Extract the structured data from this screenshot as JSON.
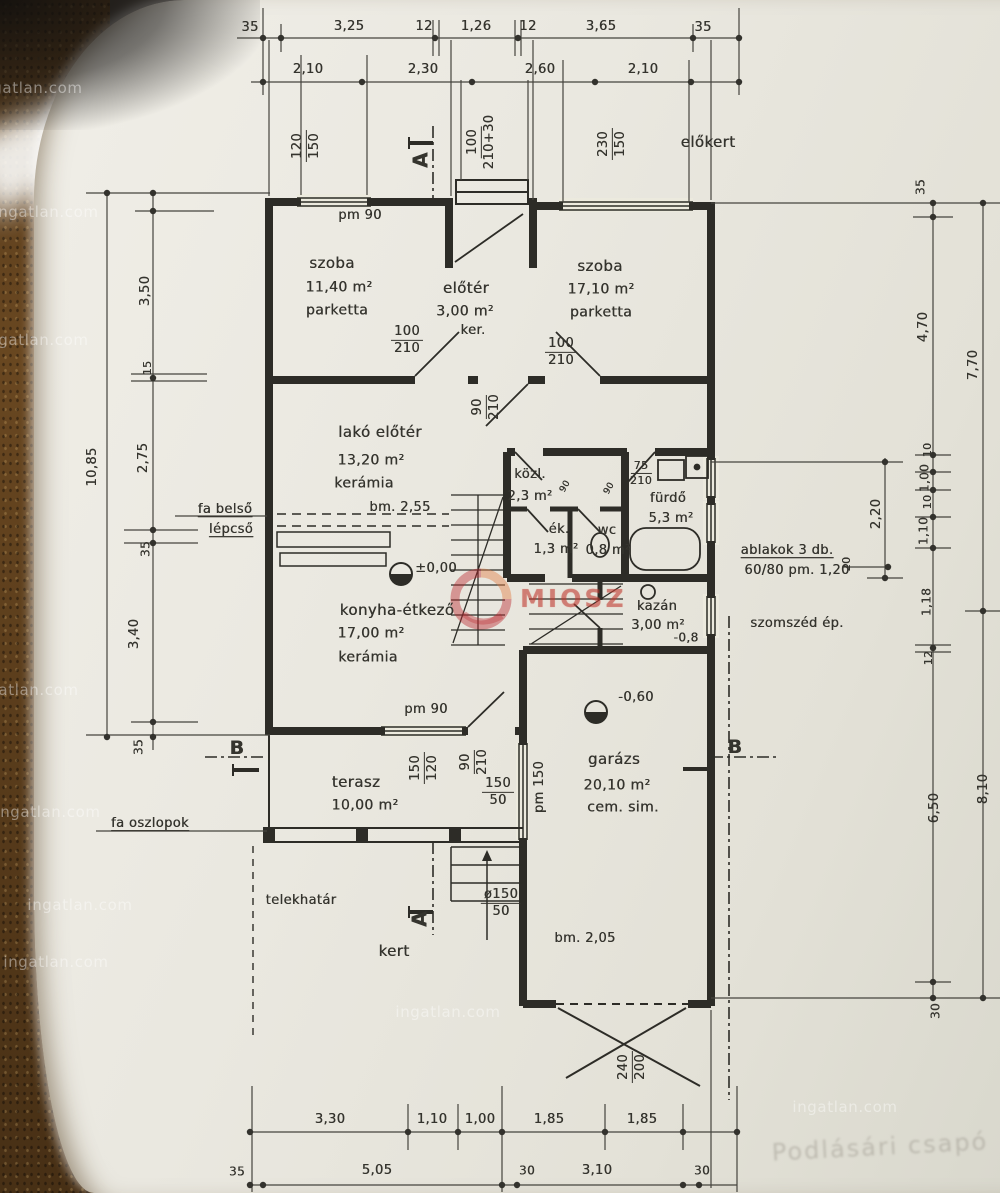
{
  "watermarks": {
    "text": "ingatlan.com",
    "positions": [
      {
        "x": 30,
        "y": 88
      },
      {
        "x": 46,
        "y": 212
      },
      {
        "x": 36,
        "y": 340
      },
      {
        "x": 26,
        "y": 690
      },
      {
        "x": 48,
        "y": 812
      },
      {
        "x": 80,
        "y": 905
      },
      {
        "x": 56,
        "y": 962
      },
      {
        "x": 448,
        "y": 1012
      },
      {
        "x": 845,
        "y": 1107
      }
    ]
  },
  "logo": {
    "text": "MIOSZ"
  },
  "faint_note": "Podlásári csapó",
  "plan": {
    "labels": [
      {
        "n": "dim-top-35-left",
        "t": "35",
        "x": 250,
        "y": 28
      },
      {
        "n": "dim-top-3-25",
        "t": "3,25",
        "x": 349,
        "y": 27
      },
      {
        "n": "dim-top-12-a",
        "t": "12",
        "x": 424,
        "y": 27
      },
      {
        "n": "dim-top-1-26",
        "t": "1,26",
        "x": 476,
        "y": 27
      },
      {
        "n": "dim-top-12-b",
        "t": "12",
        "x": 528,
        "y": 27
      },
      {
        "n": "dim-top-3-65",
        "t": "3,65",
        "x": 601,
        "y": 27
      },
      {
        "n": "dim-top-35-right",
        "t": "35",
        "x": 703,
        "y": 28
      },
      {
        "n": "dim-top2-2-10-a",
        "t": "2,10",
        "x": 308,
        "y": 70
      },
      {
        "n": "dim-top2-2-30",
        "t": "2,30",
        "x": 423,
        "y": 70
      },
      {
        "n": "dim-top2-2-60",
        "t": "2,60",
        "x": 540,
        "y": 70
      },
      {
        "n": "dim-top2-2-10-b",
        "t": "2,10",
        "x": 643,
        "y": 70
      },
      {
        "n": "window-dim-120-150",
        "t": "120|150",
        "x": 306,
        "y": 146,
        "r": -90
      },
      {
        "n": "section-letter-a-top",
        "t": "A",
        "x": 421,
        "y": 160,
        "r": -90,
        "b": 1,
        "s": 20
      },
      {
        "n": "door-dim-100-210-30",
        "t": "100|210+30",
        "x": 481,
        "y": 142,
        "r": -90
      },
      {
        "n": "window-dim-230-150",
        "t": "230|150",
        "x": 612,
        "y": 144,
        "r": -90
      },
      {
        "n": "label-elokert",
        "t": "előkert",
        "x": 708,
        "y": 143,
        "s": 15
      },
      {
        "n": "label-pm90-top",
        "t": "pm 90",
        "x": 360,
        "y": 216
      },
      {
        "n": "room-szoba1-name",
        "t": "szoba",
        "x": 332,
        "y": 264,
        "s": 15
      },
      {
        "n": "room-szoba1-area",
        "t": "11,40 m²",
        "x": 339,
        "y": 288,
        "s": 14
      },
      {
        "n": "room-szoba1-floor",
        "t": "parketta",
        "x": 337,
        "y": 311,
        "s": 14
      },
      {
        "n": "room-eloter-name",
        "t": "előtér",
        "x": 466,
        "y": 289,
        "s": 15
      },
      {
        "n": "room-eloter-area",
        "t": "3,00 m²",
        "x": 465,
        "y": 312,
        "s": 14
      },
      {
        "n": "room-eloter-floor",
        "t": "ker.",
        "x": 473,
        "y": 331
      },
      {
        "n": "room-szoba2-name",
        "t": "szoba",
        "x": 600,
        "y": 267,
        "s": 15
      },
      {
        "n": "room-szoba2-area",
        "t": "17,10 m²",
        "x": 601,
        "y": 290,
        "s": 14
      },
      {
        "n": "room-szoba2-floor",
        "t": "parketta",
        "x": 601,
        "y": 313,
        "s": 14
      },
      {
        "n": "door-dim-100-210-a",
        "t": "100|210",
        "x": 407,
        "y": 340
      },
      {
        "n": "door-dim-100-210-b",
        "t": "100|210",
        "x": 561,
        "y": 352
      },
      {
        "n": "room-lako-name",
        "t": "lakó előtér",
        "x": 380,
        "y": 433,
        "s": 15
      },
      {
        "n": "room-lako-area",
        "t": "13,20 m²",
        "x": 371,
        "y": 461,
        "s": 14
      },
      {
        "n": "room-lako-floor",
        "t": "kerámia",
        "x": 364,
        "y": 484,
        "s": 14
      },
      {
        "n": "door-dim-90-210-a",
        "t": "90|210",
        "x": 486,
        "y": 407,
        "r": -90
      },
      {
        "n": "room-kozl-name",
        "t": "közl.",
        "x": 530,
        "y": 475
      },
      {
        "n": "room-kozl-area",
        "t": "2,3 m²",
        "x": 530,
        "y": 497
      },
      {
        "n": "door-leaf-90-a",
        "t": "90",
        "x": 566,
        "y": 487,
        "r": -60,
        "s": 9
      },
      {
        "n": "door-leaf-90-b",
        "t": "90",
        "x": 610,
        "y": 489,
        "r": -60,
        "s": 9
      },
      {
        "n": "door-dim-75-210",
        "t": "75|210",
        "x": 641,
        "y": 473,
        "s": 11
      },
      {
        "n": "room-furdo-name",
        "t": "fürdő",
        "x": 668,
        "y": 499
      },
      {
        "n": "room-furdo-area",
        "t": "5,3 m²",
        "x": 671,
        "y": 519
      },
      {
        "n": "room-ek-name",
        "t": "ék.",
        "x": 559,
        "y": 530
      },
      {
        "n": "room-ek-area",
        "t": "1,3 m²",
        "x": 556,
        "y": 550
      },
      {
        "n": "room-wc-name",
        "t": "wc",
        "x": 607,
        "y": 531
      },
      {
        "n": "room-wc-area",
        "t": "0,8 m²",
        "x": 608,
        "y": 551
      },
      {
        "n": "label-bm-255",
        "t": "bm. 2,55",
        "x": 400,
        "y": 508
      },
      {
        "n": "label-fa-belso",
        "t": "fa belső",
        "x": 225,
        "y": 510,
        "u": 1
      },
      {
        "n": "label-lepcso",
        "t": "lépcső",
        "x": 231,
        "y": 530,
        "u": 1
      },
      {
        "n": "level-pm-000",
        "t": "±0,00",
        "x": 436,
        "y": 569
      },
      {
        "n": "room-konyha-name",
        "t": "konyha-étkező",
        "x": 397,
        "y": 611,
        "s": 15
      },
      {
        "n": "room-konyha-area",
        "t": "17,00 m²",
        "x": 371,
        "y": 634,
        "s": 14
      },
      {
        "n": "room-konyha-floor",
        "t": "kerámia",
        "x": 368,
        "y": 658,
        "s": 14
      },
      {
        "n": "room-kazan-name",
        "t": "kazán",
        "x": 657,
        "y": 607
      },
      {
        "n": "room-kazan-area",
        "t": "3,00 m²",
        "x": 658,
        "y": 626
      },
      {
        "n": "room-kazan-level",
        "t": "-0,8",
        "x": 686,
        "y": 638,
        "s": 12
      },
      {
        "n": "note-ablakok-1",
        "t": "ablakok 3 db.",
        "x": 787,
        "y": 551,
        "u": 1
      },
      {
        "n": "note-ablakok-2",
        "t": "60/80 pm. 1,20",
        "x": 797,
        "y": 571
      },
      {
        "n": "note-szomszed",
        "t": "szomszéd ép.",
        "x": 797,
        "y": 624
      },
      {
        "n": "level-m-060",
        "t": "-0,60",
        "x": 636,
        "y": 698
      },
      {
        "n": "label-pm90-bottom",
        "t": "pm 90",
        "x": 426,
        "y": 710
      },
      {
        "n": "section-letter-b-left",
        "t": "B",
        "x": 237,
        "y": 749,
        "b": 1,
        "s": 19
      },
      {
        "n": "room-terasz-name",
        "t": "terasz",
        "x": 356,
        "y": 783,
        "s": 15
      },
      {
        "n": "room-terasz-area",
        "t": "10,00 m²",
        "x": 365,
        "y": 806,
        "s": 14
      },
      {
        "n": "window-dim-150-120",
        "t": "150|120",
        "x": 424,
        "y": 768,
        "r": -90
      },
      {
        "n": "door-dim-90-210-b",
        "t": "90|210",
        "x": 474,
        "y": 762,
        "r": -90
      },
      {
        "n": "window-dim-150-50-a",
        "t": "150|50",
        "x": 498,
        "y": 792
      },
      {
        "n": "label-pm-150",
        "t": "pm 150",
        "x": 540,
        "y": 787,
        "r": -90
      },
      {
        "n": "room-garazs-name",
        "t": "garázs",
        "x": 614,
        "y": 760,
        "s": 15
      },
      {
        "n": "room-garazs-area",
        "t": "20,10 m²",
        "x": 617,
        "y": 786,
        "s": 14
      },
      {
        "n": "room-garazs-floor",
        "t": "cem. sim.",
        "x": 623,
        "y": 808,
        "s": 14
      },
      {
        "n": "section-letter-b-right",
        "t": "B",
        "x": 735,
        "y": 748,
        "b": 1,
        "s": 19
      },
      {
        "n": "label-fa-oszlopok",
        "t": "fa oszlopok",
        "x": 150,
        "y": 824,
        "u": 1
      },
      {
        "n": "label-telekhatar",
        "t": "telekhatár",
        "x": 301,
        "y": 901
      },
      {
        "n": "section-letter-a-bottom",
        "t": "A",
        "x": 420,
        "y": 919,
        "r": -90,
        "b": 1,
        "s": 20
      },
      {
        "n": "step-dim-150-50",
        "t": "ø150|50",
        "x": 501,
        "y": 903
      },
      {
        "n": "label-kert",
        "t": "kert",
        "x": 394,
        "y": 952,
        "s": 15
      },
      {
        "n": "label-bm-205",
        "t": "bm. 2,05",
        "x": 585,
        "y": 939
      },
      {
        "n": "garagedoor-dim-240-200",
        "t": "240|200",
        "x": 632,
        "y": 1067,
        "r": -90
      },
      {
        "n": "dim-left-10-85",
        "t": "10,85",
        "x": 93,
        "y": 467,
        "r": -90
      },
      {
        "n": "dim-left-3-50",
        "t": "3,50",
        "x": 146,
        "y": 291,
        "r": -90
      },
      {
        "n": "dim-left-15",
        "t": "15",
        "x": 148,
        "y": 368,
        "r": -90,
        "s": 11
      },
      {
        "n": "dim-left-2-75",
        "t": "2,75",
        "x": 144,
        "y": 458,
        "r": -90
      },
      {
        "n": "dim-left-35-a",
        "t": "35",
        "x": 146,
        "y": 549,
        "r": -90,
        "s": 12
      },
      {
        "n": "dim-left-3-40",
        "t": "3,40",
        "x": 135,
        "y": 634,
        "r": -90
      },
      {
        "n": "dim-left-35-b",
        "t": "35",
        "x": 139,
        "y": 747,
        "r": -90,
        "s": 12
      },
      {
        "n": "dim-right-35",
        "t": "35",
        "x": 921,
        "y": 187,
        "r": -90,
        "s": 12
      },
      {
        "n": "dim-right-4-70",
        "t": "4,70",
        "x": 924,
        "y": 327,
        "r": -90
      },
      {
        "n": "dim-right-7-70",
        "t": "7,70",
        "x": 974,
        "y": 365,
        "r": -90
      },
      {
        "n": "dim-right-10-a",
        "t": "10",
        "x": 928,
        "y": 450,
        "r": -90,
        "s": 11
      },
      {
        "n": "dim-right-1-00",
        "t": "1,00",
        "x": 925,
        "y": 478,
        "r": -90,
        "s": 12
      },
      {
        "n": "dim-right-10-b",
        "t": "10",
        "x": 928,
        "y": 502,
        "r": -90,
        "s": 11
      },
      {
        "n": "dim-right-1-10",
        "t": "1,10",
        "x": 924,
        "y": 531,
        "r": -90,
        "s": 12
      },
      {
        "n": "dim-right-2-20",
        "t": "2,20",
        "x": 877,
        "y": 514,
        "r": -90
      },
      {
        "n": "dim-right-20",
        "t": "20",
        "x": 847,
        "y": 564,
        "r": -90,
        "s": 11
      },
      {
        "n": "dim-right-1-18",
        "t": "1,18",
        "x": 927,
        "y": 602,
        "r": -90,
        "s": 12
      },
      {
        "n": "dim-right-12",
        "t": "12",
        "x": 929,
        "y": 658,
        "r": -90,
        "s": 11
      },
      {
        "n": "dim-right-6-50",
        "t": "6,50",
        "x": 935,
        "y": 808,
        "r": -90
      },
      {
        "n": "dim-right-8-10",
        "t": "8,10",
        "x": 984,
        "y": 789,
        "r": -90
      },
      {
        "n": "dim-right-30",
        "t": "30",
        "x": 936,
        "y": 1011,
        "r": -90,
        "s": 12
      },
      {
        "n": "dim-bot-3-30",
        "t": "3,30",
        "x": 330,
        "y": 1120
      },
      {
        "n": "dim-bot-1-10",
        "t": "1,10",
        "x": 432,
        "y": 1120
      },
      {
        "n": "dim-bot-1-00",
        "t": "1,00",
        "x": 480,
        "y": 1120
      },
      {
        "n": "dim-bot-1-85-a",
        "t": "1,85",
        "x": 549,
        "y": 1120
      },
      {
        "n": "dim-bot-1-85-b",
        "t": "1,85",
        "x": 642,
        "y": 1120
      },
      {
        "n": "dim-bot2-35",
        "t": "35",
        "x": 237,
        "y": 1172,
        "s": 12
      },
      {
        "n": "dim-bot2-5-05",
        "t": "5,05",
        "x": 377,
        "y": 1171
      },
      {
        "n": "dim-bot2-30-a",
        "t": "30",
        "x": 527,
        "y": 1171,
        "s": 12
      },
      {
        "n": "dim-bot2-3-10",
        "t": "3,10",
        "x": 597,
        "y": 1171
      },
      {
        "n": "dim-bot2-30-b",
        "t": "30",
        "x": 702,
        "y": 1171,
        "s": 12
      }
    ]
  }
}
